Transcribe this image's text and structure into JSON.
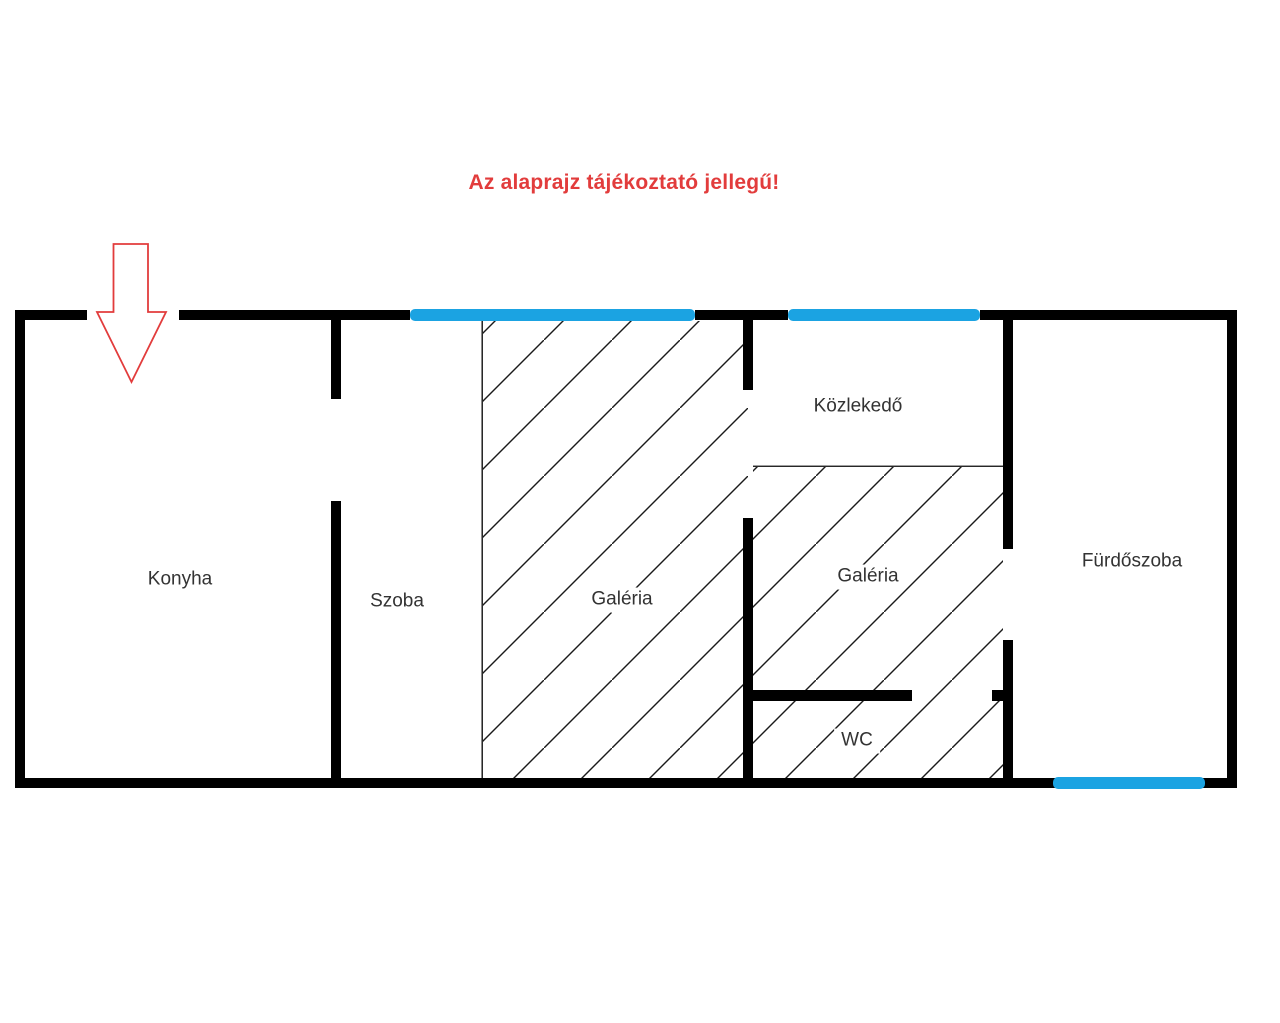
{
  "title": {
    "text": "Az alaprajz tájékoztató jellegű!",
    "color": "#e23c3c"
  },
  "floorplan": {
    "rooms": [
      {
        "id": "konyha",
        "label": "Konyha"
      },
      {
        "id": "szoba",
        "label": "Szoba"
      },
      {
        "id": "galeria_left",
        "label": "Galéria"
      },
      {
        "id": "kozlekedo",
        "label": "Közlekedő"
      },
      {
        "id": "galeria_right",
        "label": "Galéria"
      },
      {
        "id": "wc",
        "label": "WC"
      },
      {
        "id": "furdoszoba",
        "label": "Fürdőszoba"
      }
    ],
    "colors": {
      "wall": "#000000",
      "window": "#1ba3e2",
      "accent_red": "#e23c3c",
      "room_label": "#333333",
      "hatch_line": "#1a1a1a",
      "background": "#ffffff"
    },
    "icons": {
      "entrance_arrow": "entrance-arrow-icon"
    }
  }
}
